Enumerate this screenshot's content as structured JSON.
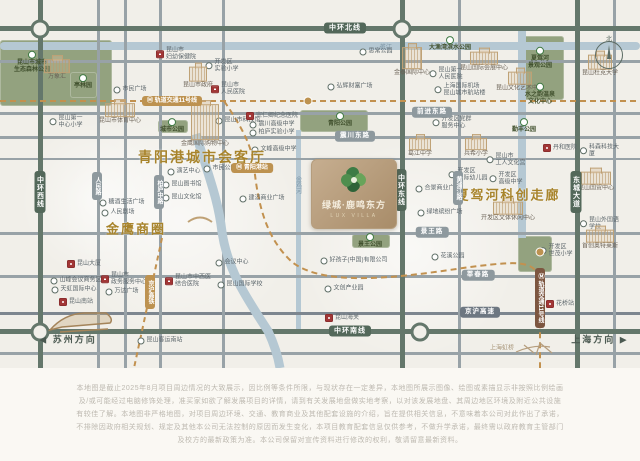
{
  "project": {
    "name": "绿城·鹿鸣东方",
    "latin": "LUX VILLA"
  },
  "compass": {
    "label": "北"
  },
  "icons": {
    "metro_icon": "Ⓜ",
    "west_arrow": "◀",
    "east_arrow": "▶"
  },
  "colors": {
    "gold": "#a8842c",
    "ring_road": "#53685a",
    "metro_gold": "#bd9250",
    "hospital_red": "#a23636",
    "park_green": "#93a27f",
    "river_blue": "#b5c8d3",
    "logo_card": "#b09473"
  },
  "directions": {
    "west": "苏州方向",
    "east": "上海方向",
    "plane_label": "上海虹桥"
  },
  "headings": [
    {
      "text": "青阳港城市会客厅",
      "x": 202,
      "y": 157,
      "size": 14
    },
    {
      "text": "金鹰商圈",
      "x": 136,
      "y": 228,
      "size": 13
    },
    {
      "text": "夏驾河科创走廊",
      "x": 508,
      "y": 194,
      "size": 13
    }
  ],
  "pills": [
    {
      "text": "中环北线",
      "x": 345,
      "y": 28,
      "cls": "ring"
    },
    {
      "text": "中环南线",
      "x": 350,
      "y": 331,
      "cls": "ring"
    },
    {
      "text": "中环西线",
      "x": 40,
      "y": 192,
      "cls": "ring v"
    },
    {
      "text": "中环东线",
      "x": 401,
      "y": 190,
      "cls": "ring v"
    },
    {
      "text": "东城大道",
      "x": 576,
      "y": 192,
      "cls": "ring v"
    },
    {
      "text": "前进东路",
      "x": 432,
      "y": 112,
      "cls": ""
    },
    {
      "text": "震川东路",
      "x": 355,
      "y": 136,
      "cls": ""
    },
    {
      "text": "景王路",
      "x": 432,
      "y": 232,
      "cls": ""
    },
    {
      "text": "莘春路",
      "x": 478,
      "y": 275,
      "cls": ""
    },
    {
      "text": "京沪高速",
      "x": 480,
      "y": 312,
      "cls": "dkgray"
    },
    {
      "text": "人民路",
      "x": 97,
      "y": 186,
      "cls": "v sm"
    },
    {
      "text": "柏庐中路",
      "x": 159,
      "y": 192,
      "cls": "v sm"
    },
    {
      "text": "黄浦江路",
      "x": 458,
      "y": 188,
      "cls": "v sm"
    },
    {
      "text": "轨道交通11号线",
      "x": 172,
      "y": 101,
      "cls": "gold sm",
      "m": true
    },
    {
      "text": "青阳港站",
      "x": 252,
      "y": 168,
      "cls": "gold sm",
      "m": true
    },
    {
      "text": "轨道交通11号线",
      "x": 540,
      "y": 298,
      "cls": "brown v sm",
      "m": true
    },
    {
      "text": "京沪高铁",
      "x": 150,
      "y": 292,
      "cls": "gold v sm"
    }
  ],
  "river_labels": [
    {
      "text": "娄江",
      "x": 385,
      "y": 46,
      "v": false
    },
    {
      "text": "金鸡河",
      "x": 298,
      "y": 185,
      "v": true
    }
  ],
  "pois": [
    {
      "t": "green",
      "l": "昆山市城市\n生态森林公园",
      "x": 32,
      "y": 62
    },
    {
      "t": "sketch",
      "l": "万象汇",
      "x": 57,
      "y": 70,
      "w": 24,
      "h": 12
    },
    {
      "t": "green",
      "l": "亭林园",
      "x": 83,
      "y": 82
    },
    {
      "t": "dot",
      "l": "昆山第一\n中心小学",
      "x": 66,
      "y": 122
    },
    {
      "t": "sketch",
      "l": "昆山市体育中心",
      "x": 120,
      "y": 114,
      "w": 28,
      "h": 12
    },
    {
      "t": "green",
      "l": "城市公园",
      "x": 172,
      "y": 126
    },
    {
      "t": "dot",
      "l": "昆山市科技馆",
      "x": 238,
      "y": 121
    },
    {
      "t": "red",
      "l": "昆山市\n妇幼保健院",
      "x": 176,
      "y": 54
    },
    {
      "t": "dot",
      "l": "开发区\n实验小学",
      "x": 222,
      "y": 66
    },
    {
      "t": "sketch",
      "l": "昆山市政府",
      "x": 198,
      "y": 78,
      "w": 16,
      "h": 13
    },
    {
      "t": "dot",
      "l": "市民广场",
      "x": 130,
      "y": 90
    },
    {
      "t": "red",
      "l": "昆山市\n人民医院",
      "x": 228,
      "y": 89
    },
    {
      "t": "dot",
      "l": "思常公园",
      "x": 376,
      "y": 52
    },
    {
      "t": "dot",
      "l": "弘辉财富广场",
      "x": 350,
      "y": 87
    },
    {
      "t": "sketch",
      "l": "金泰国际中心",
      "x": 412,
      "y": 62,
      "w": 18,
      "h": 20
    },
    {
      "t": "dot",
      "l": "昆山第一\n人民医院",
      "x": 446,
      "y": 74
    },
    {
      "t": "green",
      "l": "大渔湾滨水公园",
      "x": 450,
      "y": 44
    },
    {
      "t": "sketch",
      "l": "昆山国际会展中心",
      "x": 484,
      "y": 62,
      "w": 26,
      "h": 11
    },
    {
      "t": "dot",
      "l": "上海国际机场\n昆山城市航站楼",
      "x": 460,
      "y": 90
    },
    {
      "t": "sketch",
      "l": "昆山文化艺术中心",
      "x": 520,
      "y": 82,
      "w": 22,
      "h": 11
    },
    {
      "t": "green",
      "l": "夏驾河\n景观公园",
      "x": 540,
      "y": 58
    },
    {
      "t": "green",
      "l": "水之韵温泉\n文化中心",
      "x": 540,
      "y": 94
    },
    {
      "t": "sketch",
      "l": "昆山杜克大学",
      "x": 600,
      "y": 66,
      "w": 22,
      "h": 13
    },
    {
      "t": "red",
      "l": "宗仁卿纪念医院",
      "x": 272,
      "y": 116
    },
    {
      "t": "dot",
      "l": "震川高级中学",
      "x": 272,
      "y": 125
    },
    {
      "t": "dot",
      "l": "柏庐实验小学",
      "x": 272,
      "y": 133
    },
    {
      "t": "dot",
      "l": "文峰高级中学",
      "x": 274,
      "y": 150
    },
    {
      "t": "dot",
      "l": "演艺中心",
      "x": 184,
      "y": 172
    },
    {
      "t": "dot",
      "l": "昆山图书馆",
      "x": 182,
      "y": 185
    },
    {
      "t": "dot",
      "l": "昆山文化馆",
      "x": 182,
      "y": 198
    },
    {
      "t": "dot",
      "l": "市民公园",
      "x": 220,
      "y": 169
    },
    {
      "t": "dot",
      "l": "建滔商业广场",
      "x": 262,
      "y": 199
    },
    {
      "t": "sketch",
      "l": "金鹰国际购物中心",
      "x": 205,
      "y": 126,
      "w": 26,
      "h": 34
    },
    {
      "t": "dot",
      "l": "糖酒生活广场",
      "x": 122,
      "y": 203
    },
    {
      "t": "dot",
      "l": "人民剧场",
      "x": 118,
      "y": 213
    },
    {
      "t": "green",
      "l": "青阳公园",
      "x": 340,
      "y": 120
    },
    {
      "t": "green",
      "l": "景王公园",
      "x": 370,
      "y": 241
    },
    {
      "t": "green",
      "l": "勤丰公园",
      "x": 524,
      "y": 126
    },
    {
      "t": "dot",
      "l": "开发区党群\n服务中心",
      "x": 452,
      "y": 123
    },
    {
      "t": "sketch",
      "l": "葛江中学",
      "x": 420,
      "y": 148,
      "w": 20,
      "h": 10
    },
    {
      "t": "sketch",
      "l": "兵希小学",
      "x": 476,
      "y": 148,
      "w": 20,
      "h": 10
    },
    {
      "t": "dot",
      "l": "昆山市\n工人文化宫",
      "x": 506,
      "y": 160
    },
    {
      "t": "dot",
      "l": "开发区\n国际幼儿园",
      "x": 468,
      "y": 175
    },
    {
      "t": "dot",
      "l": "开发区\n高级中学",
      "x": 506,
      "y": 179
    },
    {
      "t": "dot",
      "l": "合景商业广场",
      "x": 438,
      "y": 189
    },
    {
      "t": "dot",
      "l": "绿地缤纷广场",
      "x": 440,
      "y": 213
    },
    {
      "t": "sketch",
      "l": "开发区文体休闲中心",
      "x": 508,
      "y": 212,
      "w": 28,
      "h": 11
    },
    {
      "t": "red",
      "l": "丹和医院",
      "x": 560,
      "y": 148
    },
    {
      "t": "dot",
      "l": "科森科技大厦",
      "x": 600,
      "y": 151
    },
    {
      "t": "sketch",
      "l": "昆山国贸中心",
      "x": 596,
      "y": 182,
      "w": 28,
      "h": 11
    },
    {
      "t": "dot",
      "l": "昆山外国语学校",
      "x": 600,
      "y": 224
    },
    {
      "t": "dot",
      "l": "开发区\n世茂小学",
      "x": 556,
      "y": 251
    },
    {
      "t": "sketch",
      "l": "首创奥特莱斯",
      "x": 600,
      "y": 240,
      "w": 26,
      "h": 11
    },
    {
      "t": "dot",
      "l": "会议中心",
      "x": 232,
      "y": 263
    },
    {
      "t": "dot",
      "l": "昆山国际学校",
      "x": 240,
      "y": 285
    },
    {
      "t": "dot",
      "l": "好孩子(中国)有限公司",
      "x": 354,
      "y": 261
    },
    {
      "t": "dot",
      "l": "文创产业园",
      "x": 344,
      "y": 289
    },
    {
      "t": "red",
      "l": "昆山海关",
      "x": 342,
      "y": 318
    },
    {
      "t": "red",
      "l": "昆山大厦",
      "x": 84,
      "y": 264
    },
    {
      "t": "red",
      "l": "昆山市\n政务服务中心",
      "x": 124,
      "y": 279
    },
    {
      "t": "dot",
      "l": "万达广场",
      "x": 122,
      "y": 292
    },
    {
      "t": "dot",
      "l": "山峰会议商务区",
      "x": 76,
      "y": 281
    },
    {
      "t": "dot",
      "l": "天虹国际中心",
      "x": 74,
      "y": 290
    },
    {
      "t": "red",
      "l": "昆山南站",
      "x": 76,
      "y": 302
    },
    {
      "t": "red",
      "l": "昆山市中西医\n结合医院",
      "x": 188,
      "y": 281
    },
    {
      "t": "dot",
      "l": "昆山客运南站",
      "x": 160,
      "y": 341
    },
    {
      "t": "red",
      "l": "花桥站",
      "x": 560,
      "y": 304
    },
    {
      "t": "dot",
      "l": "花溪公园",
      "x": 448,
      "y": 257
    }
  ],
  "disclaimer": {
    "l1": "本地图是截止2025年8月项目周边情况的大致展示，因比例等条件所限，与现状存在一定差异，本地图所展示图像、绘图或素描显示非按照比例绘画",
    "l2": "及/或可能经过电脑修饰处理，准买家如欲了解发展项目的详情，请到有关发展地盘做实地考察，以对该发展地盘、其周边地区环境及附近公共设施",
    "l3": "有较佳了解。本地图非严格地图，对项目周边环境、交通、教育商业及其他配套设施的介绍，旨在提供相关信息，不意味着本公司对此作出了承诺，",
    "l4": "不排除因政府相关规划、规定及其他本公司无法控制的原因而发生变化，本项目教育配套信息仅供参考，不做升学承诺，最终需以政府教育主管部门",
    "l5": "及校方的最新政策为准。本公司保留对宣传资料进行修改的权利，敬请留意最新资料。"
  }
}
